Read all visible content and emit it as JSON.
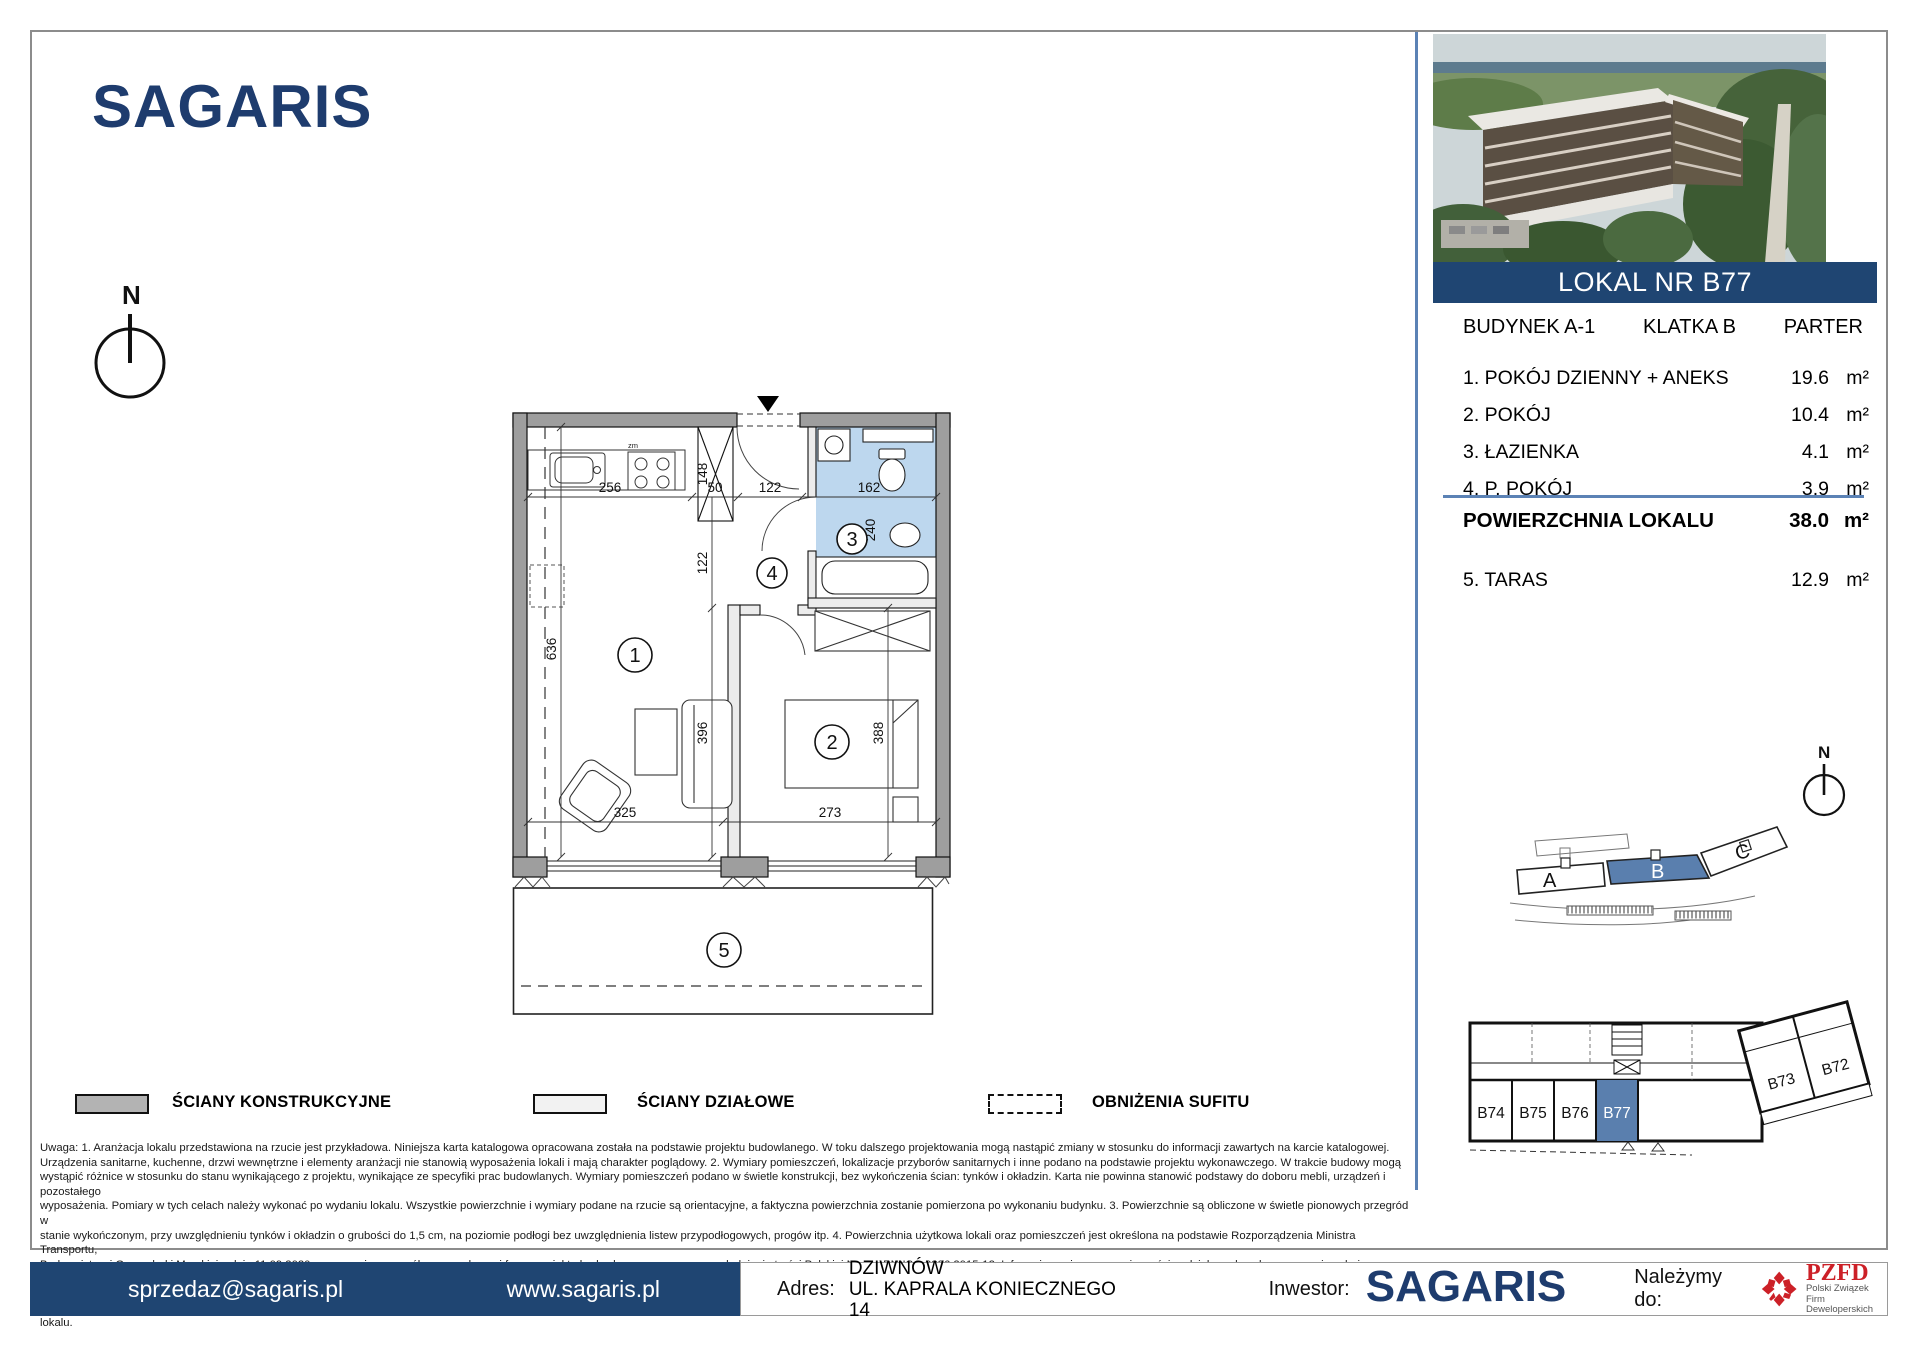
{
  "logo": {
    "text": "SAGARIS"
  },
  "compass": {
    "north": "N"
  },
  "photo": {
    "description": "aerial-render-of-apartment-complex"
  },
  "unit_banner": {
    "title": "LOKAL NR B77"
  },
  "unit_info": {
    "building": "BUDYNEK A-1",
    "staircase": "KLATKA B",
    "floor": "PARTER"
  },
  "rooms": [
    {
      "name": "1. POKÓJ DZIENNY + ANEKS",
      "area": "19.6",
      "unit": "m²"
    },
    {
      "name": "2. POKÓJ",
      "area": "10.4",
      "unit": "m²"
    },
    {
      "name": "3. ŁAZIENKA",
      "area": "4.1",
      "unit": "m²"
    },
    {
      "name": "4. P. POKÓJ",
      "area": "3.9",
      "unit": "m²"
    }
  ],
  "total": {
    "label": "POWIERZCHNIA LOKALU",
    "area": "38.0",
    "unit": "m²"
  },
  "extra": {
    "name": "5. TARAS",
    "area": "12.9",
    "unit": "m²"
  },
  "plan": {
    "dim_256": "256",
    "dim_50": "50",
    "dim_122_top": "122",
    "dim_162": "162",
    "dim_148": "148",
    "dim_122_mid": "122",
    "dim_240": "240",
    "dim_636": "636",
    "dim_396": "396",
    "dim_388": "388",
    "dim_325": "325",
    "dim_273": "273",
    "room1": "1",
    "room2": "2",
    "room3": "3",
    "room4": "4",
    "room5": "5",
    "stove_label": "zm"
  },
  "legend": {
    "items": [
      {
        "label": "ŚCIANY KONSTRUKCYJNE"
      },
      {
        "label": "ŚCIANY DZIAŁOWE"
      },
      {
        "label": "OBNIŻENIA SUFITU"
      }
    ]
  },
  "site_plan": {
    "a": "A",
    "b": "B",
    "c": "C"
  },
  "floor_strip": {
    "u74": "B74",
    "u75": "B75",
    "u76": "B76",
    "u77": "B77",
    "u73": "B73",
    "u72": "B72"
  },
  "notes": {
    "lines": [
      "Uwaga:    1. Aranżacja lokalu przedstawiona na rzucie jest przykładowa. Niniejsza karta katalogowa opracowana została na podstawie projektu budowlanego. W toku dalszego projektowania mogą nastąpić zmiany w stosunku do informacji zawartych na karcie katalogowej.",
      "Urządzenia sanitarne, kuchenne, drzwi wewnętrzne i elementy aranżacji nie stanowią wyposażenia lokali i mają charakter poglądowy.    2. Wymiary pomieszczeń, lokalizacje przyborów sanitarnych i inne podano na podstawie projektu wykonawczego. W trakcie budowy mogą",
      "wystąpić różnice w stosunku do stanu wynikającego z projektu, wynikające ze specyfiki prac budowlanych. Wymiary pomieszczeń podano w świetle konstrukcji, bez wykończenia ścian: tynków i okładzin. Karta nie powinna stanowić podstawy do doboru mebli, urządzeń i pozostałego",
      "wyposażenia. Pomiary w tych celach należy wykonać po wydaniu lokalu. Wszystkie powierzchnie i wymiary podane na rzucie są orientacyjne, a faktyczna powierzchnia zostanie pomierzona po wykonaniu budynku.    3. Powierzchnie są obliczone w świetle pionowych przegród w",
      "stanie wykończonym, przy uwzględnieniu tynków i okładzin o grubości do 1,5 cm, na poziomie podłogi bez uwzględnienia listew przypodłogowych, progów itp.    4. Powierzchnia użytkowa lokali oraz pomieszczeń jest określona na podstawie Rozporządzenia Ministra Transportu,",
      "Budownictwa i Gospodarki Morskiej z dnia 11.09.2020 r. w sprawie szczegółowego zakresu i formy projektu budowlanego oraz przy uwzględnieniu treści Polskiej Normy PN-ISO 9836:2015-12. Informujemy, że rezygnacja ze ścian działowych wpływa na powierzchnię użytkową.",
      "5. Informacje na karcie nie stanowią oferty handlowej w rozumieniu art. 66 kodeksu cywilnego.    6. Rzeczywista wielkość i kształt balkonu/tarasu zostaną ostatecznie podane po zakończeniu budowy. Powierzchnia i kształt balkonu/tarasu jest szacunkowa i nie ma wpływu na cenę",
      "lokalu."
    ]
  },
  "footer": {
    "email": "sprzedaz@sagaris.pl",
    "website": "www.sagaris.pl",
    "address_label": "Adres:",
    "address_line1": "DZIWNÓW",
    "address_line2": "UL. KAPRALA KONIECZNEGO 14",
    "investor_label": "Inwestor:",
    "investor_name": "SAGARIS",
    "member_label": "Należymy do:",
    "pzfd_abbr": "PZFD",
    "pzfd_line1": "Polski Związek",
    "pzfd_line2": "Firm Deweloperskich"
  },
  "colors": {
    "navy": "#1e3c6e",
    "banner_blue": "#1f4572",
    "divider_blue": "#5b82b5",
    "highlight_blue": "#5a7fae",
    "bath_blue": "#bdd7ee",
    "wall_gray": "#9e9e9e",
    "pzfd_red": "#cc2027"
  }
}
